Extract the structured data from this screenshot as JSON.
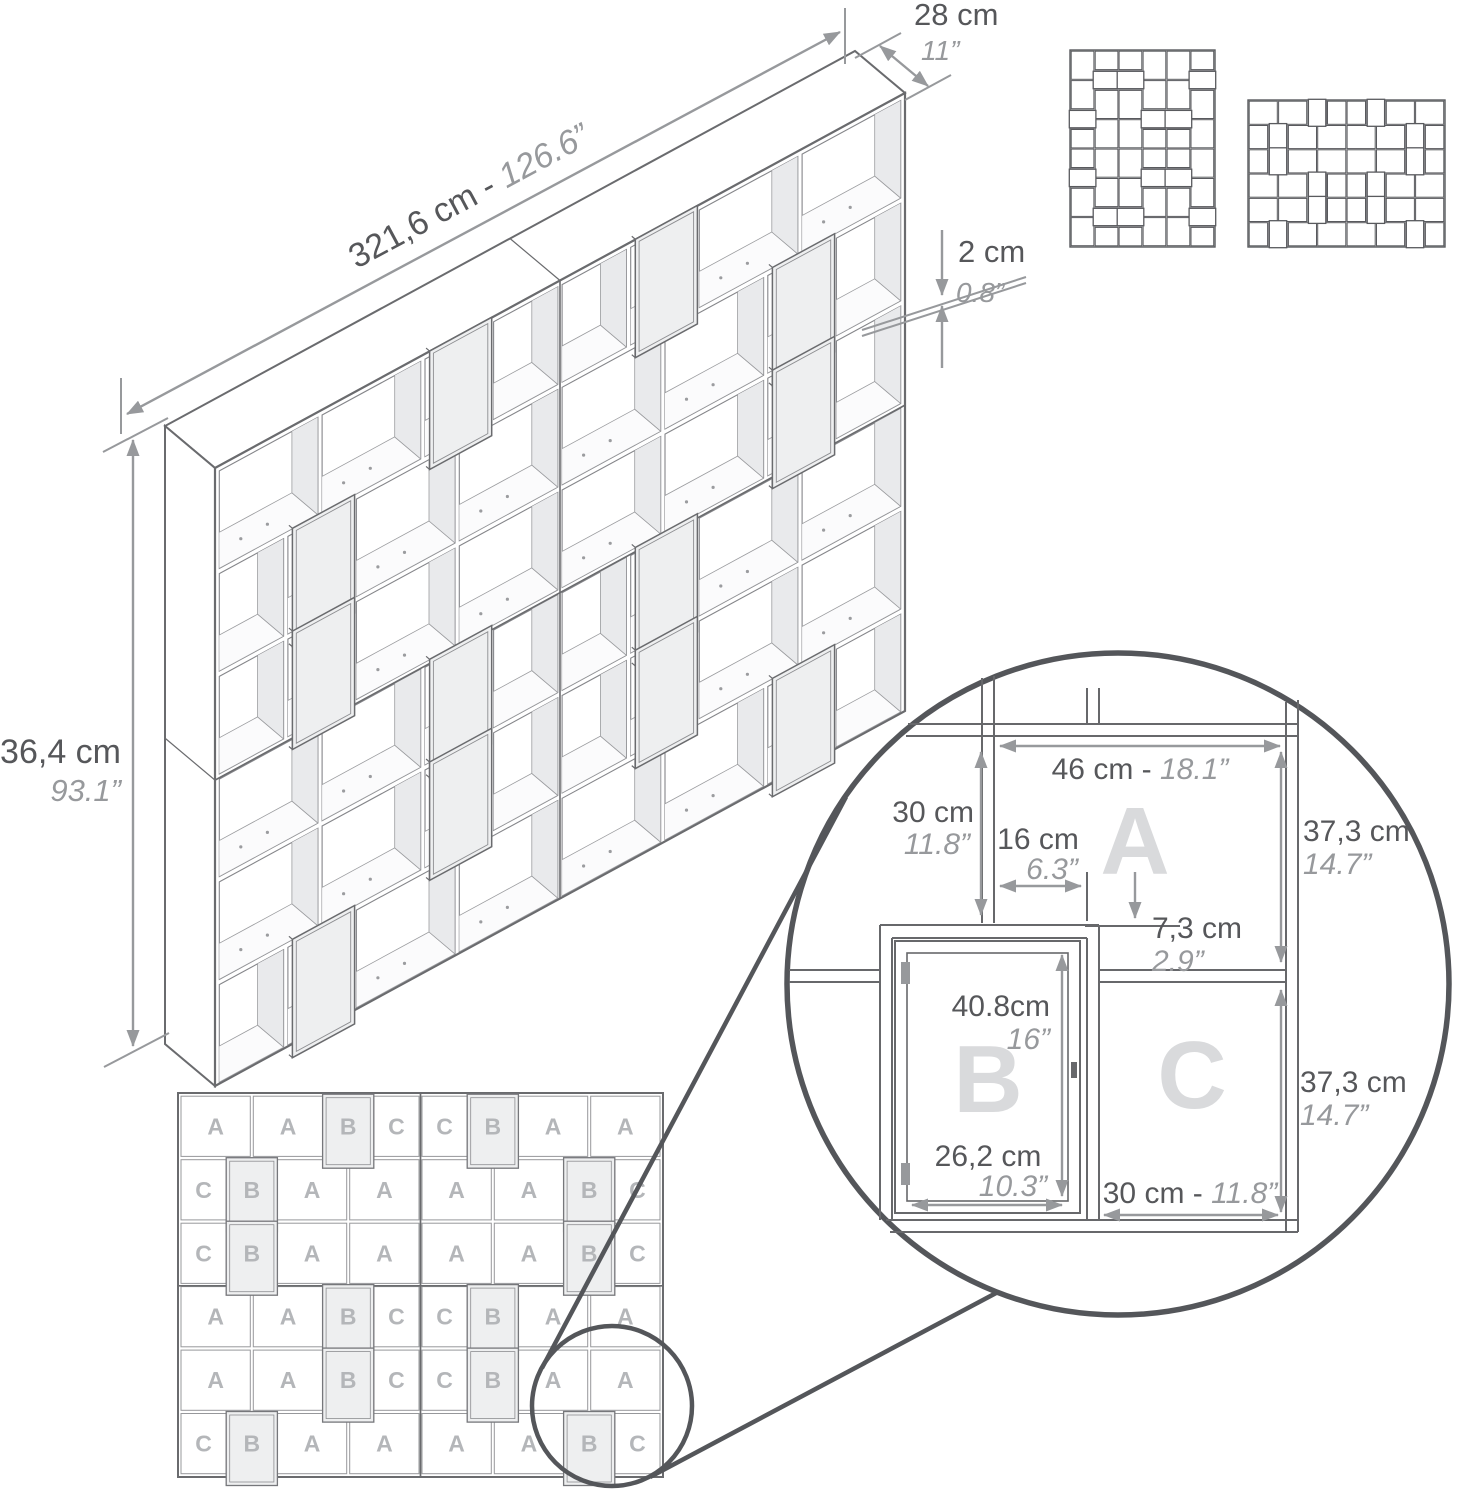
{
  "colors": {
    "line": "#6a6b6e",
    "cell_stroke": "#85868a",
    "thin_stroke": "#9b9c9f",
    "dim": "#97999c",
    "dim_text": "#56575a",
    "letter": "#b4b6b9",
    "letter_big": "#d9dadc",
    "panel_shade": "#e9eaec",
    "floor_shade": "#fbfbfc",
    "door_fill": "#eeeff0",
    "door_stroke": "#76777b",
    "circle": "#54565a"
  },
  "iso": {
    "width_cm": "321,6 cm - ",
    "width_in": "126.6”",
    "depth_cm": "28 cm",
    "depth_in": "11”",
    "thickness_cm": "2 cm",
    "thickness_in": "0.8”",
    "height_cm": "236,4 cm",
    "height_in": "93.1”"
  },
  "detail": {
    "a_width_cm": "46 cm - ",
    "a_width_in": "18.1”",
    "slot_h_cm": "30 cm",
    "slot_h_in": "11.8”",
    "slot_w_cm": "16 cm",
    "slot_w_in": "6.3”",
    "offset_cm": "7,3 cm",
    "offset_in": "2.9”",
    "door_h_cm": "40.8cm",
    "door_h_in": "16”",
    "door_w_cm": "26,2 cm",
    "door_w_in": "10.3”",
    "c_width_cm": "30 cm - ",
    "c_width_in": "11.8”",
    "row_h_top_cm": "37,3 cm",
    "row_h_top_in": "14.7”",
    "row_h_bot_cm": "37,3 cm",
    "row_h_bot_in": "14.7”",
    "letter_a": "A",
    "letter_b": "B",
    "letter_c": "C"
  },
  "front_grid": {
    "row_types": [
      0,
      1,
      1,
      0,
      0,
      1
    ],
    "widths": [
      [
        46,
        46,
        30,
        30,
        30,
        30,
        46,
        46
      ],
      [
        30,
        30,
        46,
        46,
        46,
        46,
        30,
        30
      ]
    ],
    "rows": [
      [
        "A",
        "A",
        "B",
        "C",
        "C",
        "B",
        "A",
        "A"
      ],
      [
        "C",
        "B",
        "A",
        "A",
        "A",
        "A",
        "B",
        "C"
      ],
      [
        "C",
        "B",
        "A",
        "A",
        "A",
        "A",
        "B",
        "C"
      ],
      [
        "A",
        "A",
        "B",
        "C",
        "C",
        "B",
        "A",
        "A"
      ],
      [
        "A",
        "A",
        "B",
        "C",
        "C",
        "B",
        "A",
        "A"
      ],
      [
        "C",
        "B",
        "A",
        "A",
        "A",
        "A",
        "B",
        "C"
      ]
    ],
    "door_letter": "B",
    "row_height_cm": 37.3,
    "row_pitch_cm": 39.3,
    "panel_cm": 2,
    "total_width_cm": 322,
    "total_height_cm": 237.8
  }
}
